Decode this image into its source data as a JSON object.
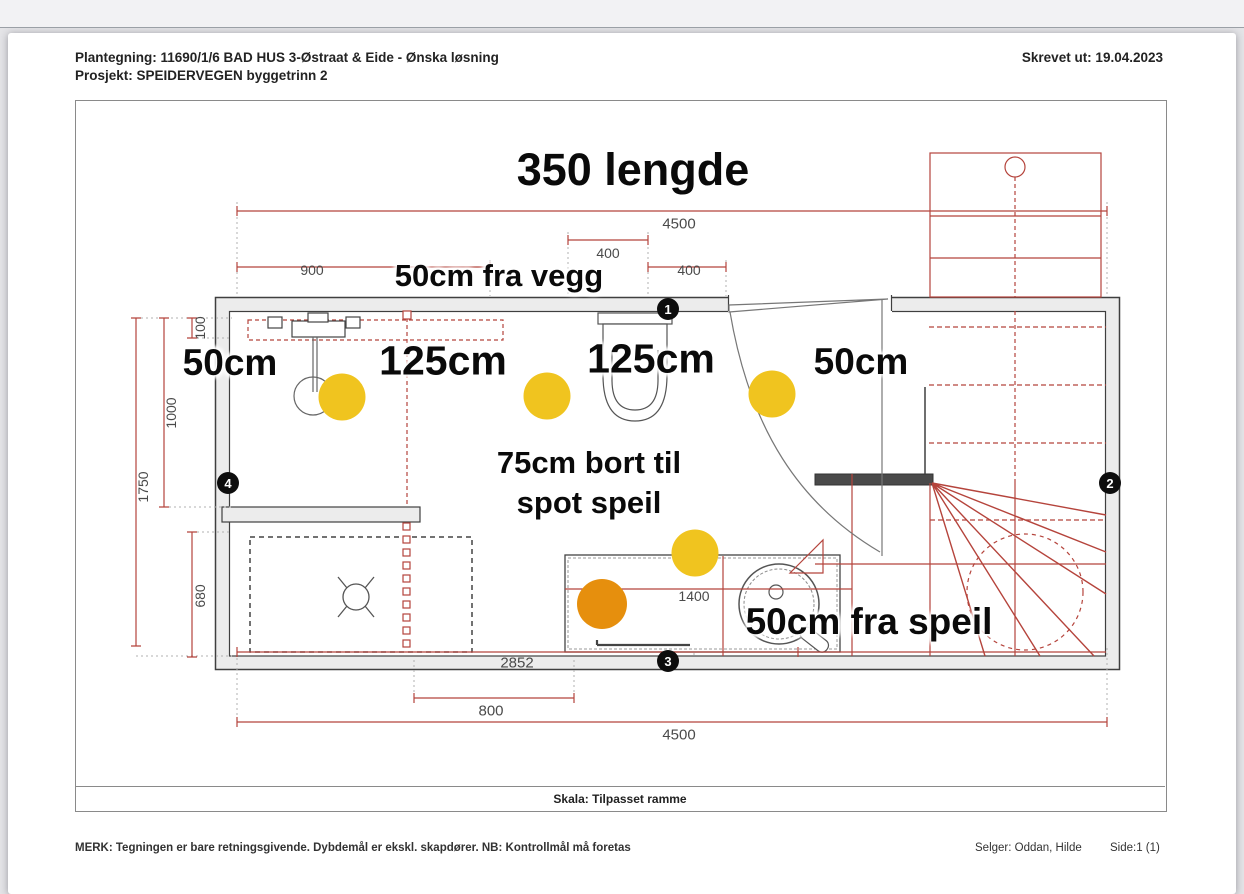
{
  "header": {
    "plantegning": "Plantegning:  11690/1/6  BAD HUS 3-Østraat & Eide - Ønska løsning",
    "prosjekt": "Prosjekt:  SPEIDERVEGEN byggetrinn 2",
    "printed": "Skrevet ut: 19.04.2023"
  },
  "annotations": {
    "length": "350 lengde",
    "from_wall": "50cm fra vegg",
    "spot1": "50cm",
    "spot2": "125cm",
    "spot3": "125cm",
    "spot4": "50cm",
    "mirror_line1": "75cm bort til",
    "mirror_line2": "spot speil",
    "from_mirror": "50cm fra speil"
  },
  "dims": {
    "top_total": "4500",
    "top_400a": "400",
    "top_900": "900",
    "top_400b": "400",
    "left_100": "100",
    "left_1000": "1000",
    "left_1750": "1750",
    "left_680": "680",
    "bottom_2852": "2852",
    "bottom_800": "800",
    "bottom_total": "4500",
    "vanity_1400": "1400"
  },
  "markers": {
    "m1": "1",
    "m2": "2",
    "m3": "3",
    "m4": "4"
  },
  "footer": {
    "skala": "Skala: Tilpasset ramme",
    "merk": "MERK: Tegningen er bare retningsgivende. Dybdemål er ekskl. skapdører. NB: Kontrollmål må foretas",
    "selger": "Selger: Oddan, Hilde",
    "side": "Side:1 (1)"
  },
  "colors": {
    "dim_red": "#b5443c",
    "spot_yellow": "#f0c41f",
    "spot_orange": "#e68f0d",
    "wall_fill": "#ececec",
    "wall_edge": "#3f3f3f"
  }
}
